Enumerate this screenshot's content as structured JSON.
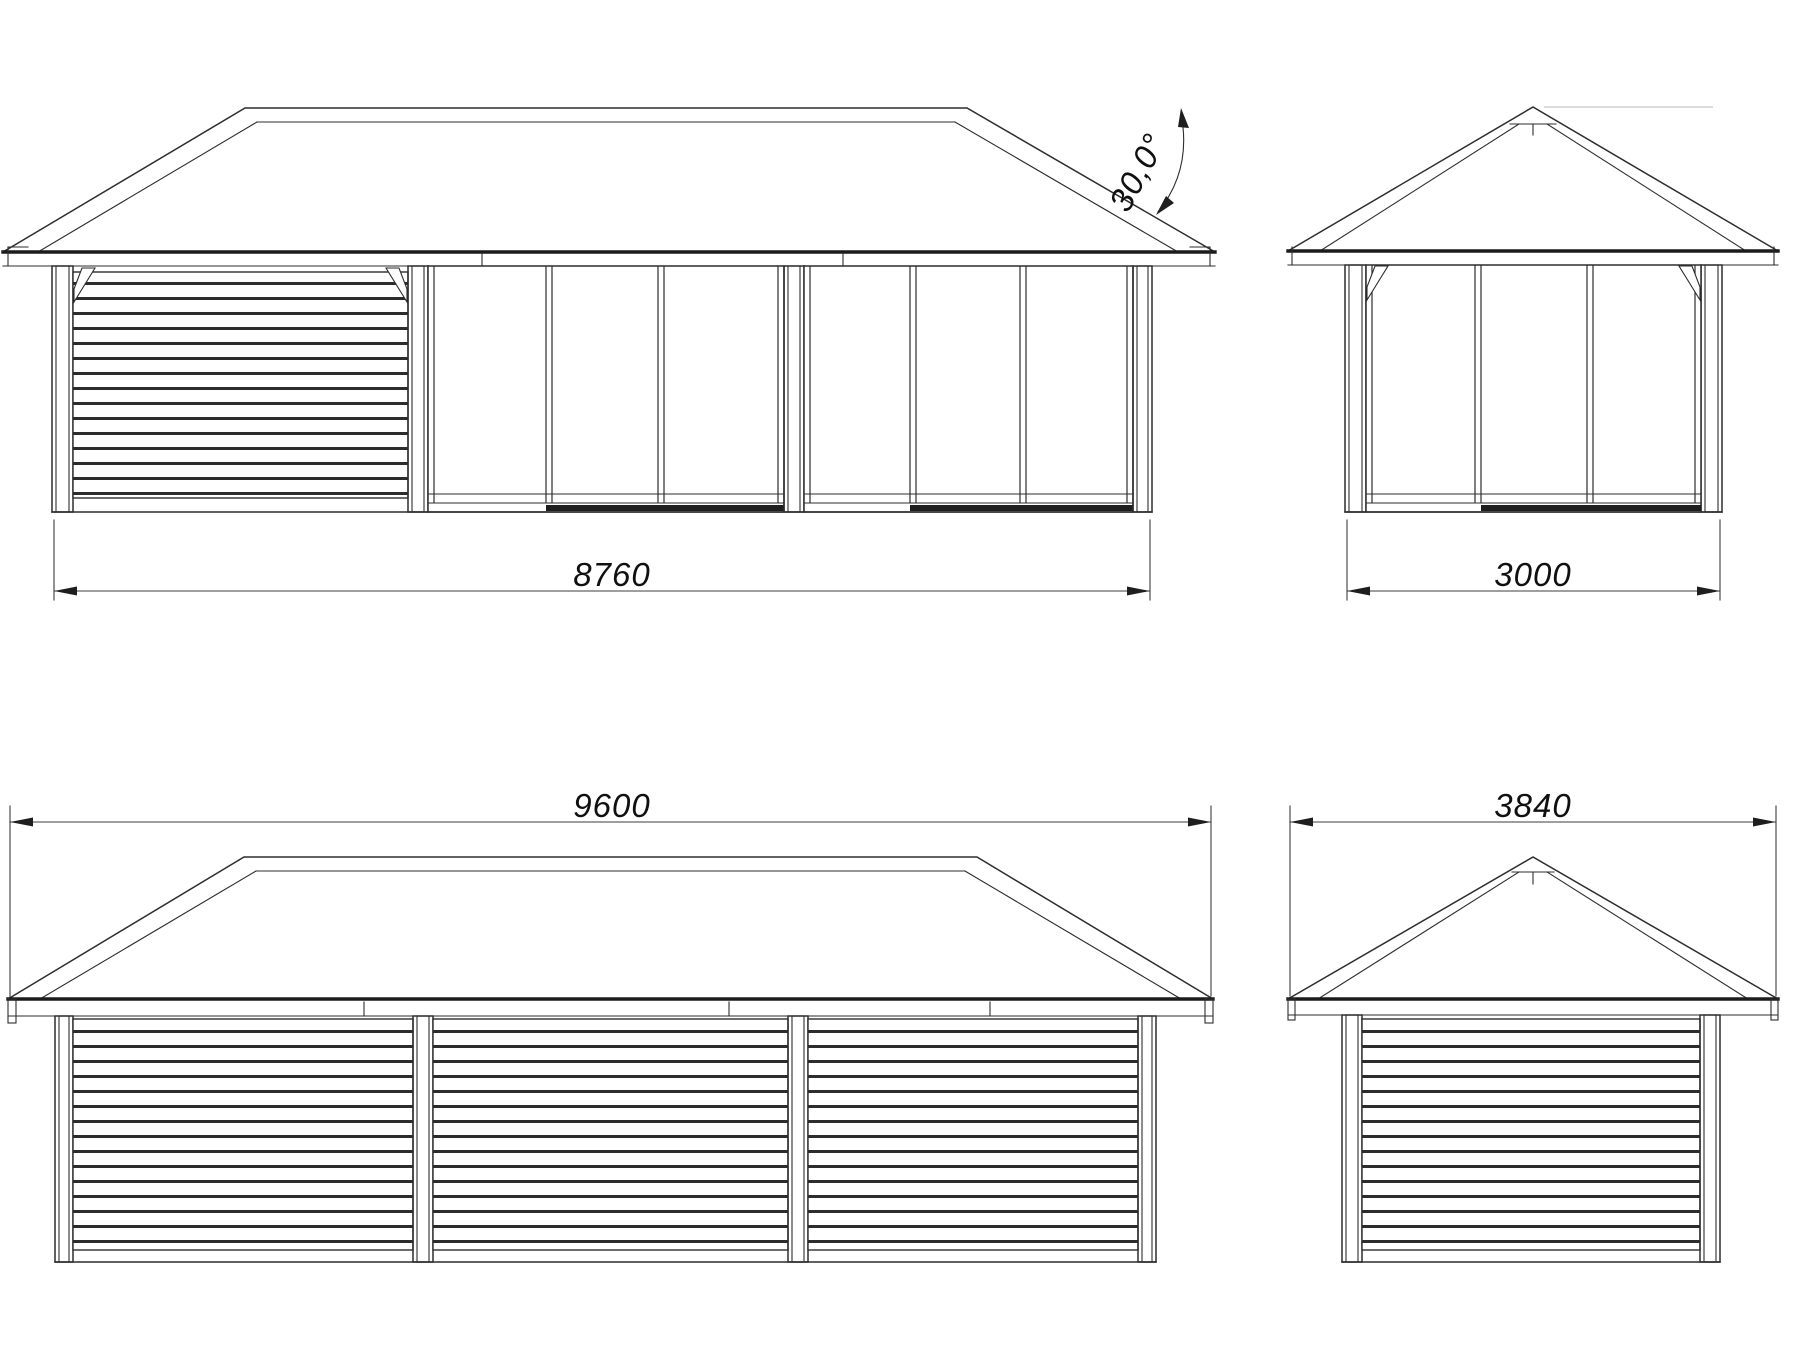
{
  "drawing": {
    "type": "pavilion-elevation-technical-drawing",
    "labels": {
      "front_wall_width_mm": "8760",
      "side_wall_width_mm": "3000",
      "rear_roof_width_mm": "9600",
      "side_roof_width_mm": "3840",
      "roof_pitch_deg": "30,0°"
    },
    "colors": {
      "line": "#2d2d2d",
      "heavy_line": "#1b1b1b",
      "dimension_line": "#3c3c3c",
      "text": "#101010",
      "reference_line": "#cfcfcf",
      "background": "#ffffff"
    }
  }
}
